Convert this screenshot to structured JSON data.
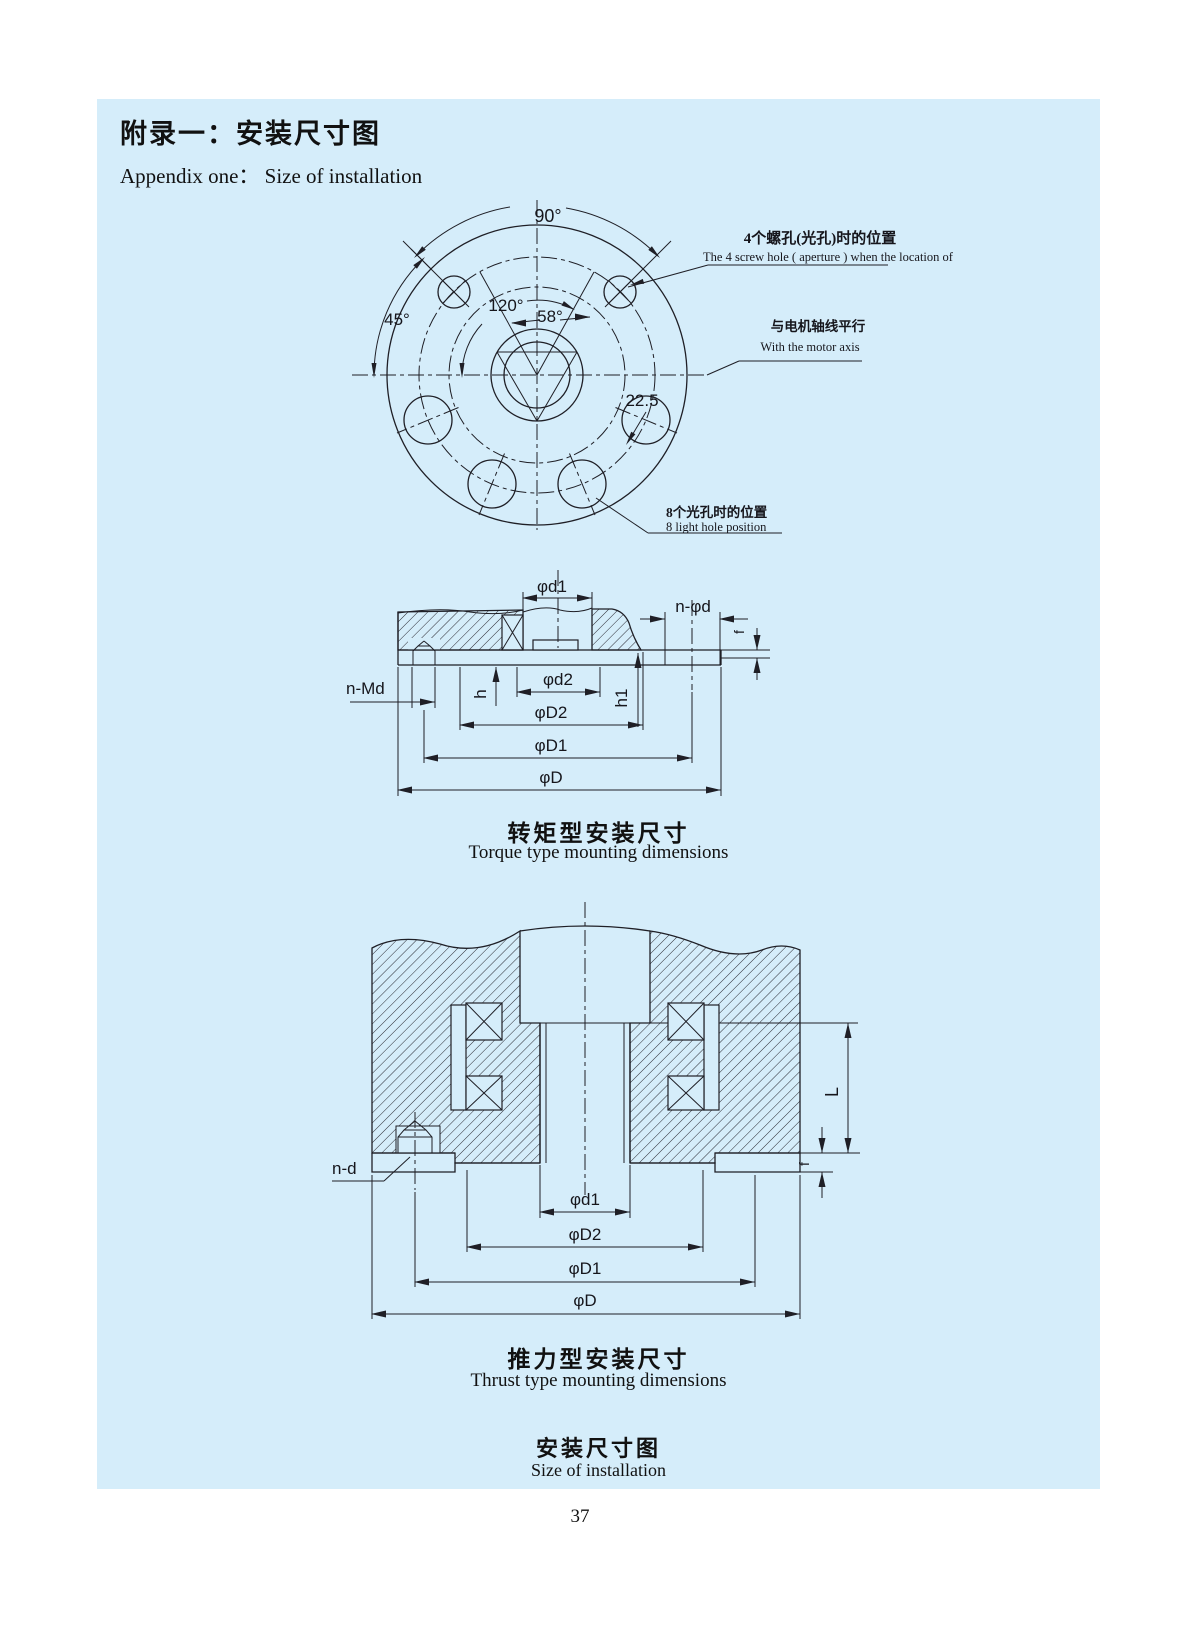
{
  "page": {
    "number": "37"
  },
  "header": {
    "title_cn": "附录一：安装尺寸图",
    "title_en": "Appendix one：  Size of installation"
  },
  "flange": {
    "angle_90": "90°",
    "angle_45": "45°",
    "angle_120": "120°",
    "angle_58": "58°",
    "angle_22_5": "22.5",
    "screw_note_cn": "4个螺孔(光孔)时的位置",
    "screw_note_en": "The 4 screw hole ( aperture ) when the location of",
    "motor_note_cn": "与电机轴线平行",
    "motor_note_en": "With the motor axis",
    "light_note_cn": "8个光孔时的位置",
    "light_note_en": "8 light hole position"
  },
  "torque": {
    "labels": {
      "d1": "φd1",
      "n_phid": "n-φd",
      "f": "f",
      "n_md": "n-Md",
      "h": "h",
      "d2": "φd2",
      "D2": "φD2",
      "h1": "h1",
      "D1": "φD1",
      "D": "φD"
    },
    "caption_cn": "转矩型安装尺寸",
    "caption_en": "Torque type mounting dimensions"
  },
  "thrust": {
    "labels": {
      "n_d": "n-d",
      "d1": "φd1",
      "D2": "φD2",
      "D1": "φD1",
      "D": "φD",
      "L": "L",
      "f": "f"
    },
    "caption_cn": "推力型安装尺寸",
    "caption_en": "Thrust type mounting dimensions"
  },
  "footer": {
    "caption_cn": "安装尺寸图",
    "caption_en": "Size of installation"
  }
}
